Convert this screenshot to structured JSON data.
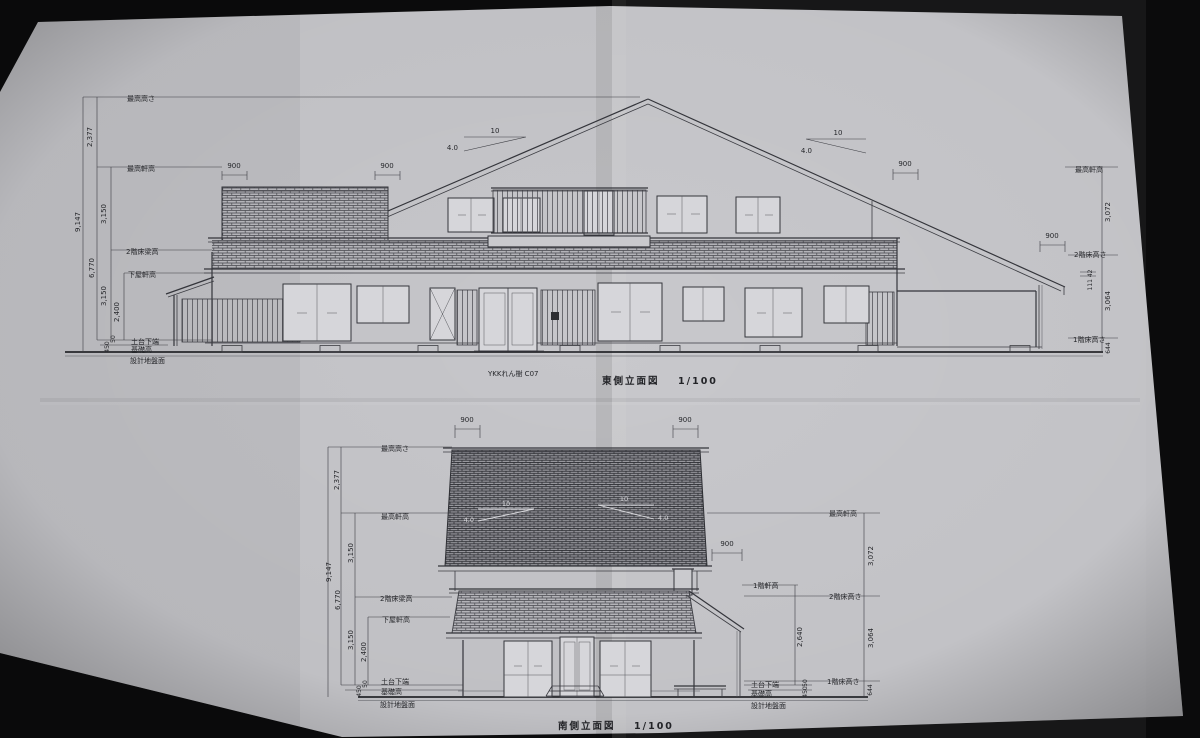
{
  "photo": {
    "background": "#0b0b0c",
    "paper": "#c6c6ca",
    "ink": "#34353b"
  },
  "east": {
    "title": "東側立面図",
    "scale": "1/100",
    "door_note": "YKKれん樹 C07",
    "labels": {
      "max_height": "最高高さ",
      "max_eave": "最高軒高",
      "fl2_beam": "2階床梁高",
      "lower_eave": "下屋軒高",
      "sill": "土台下端",
      "foundation": "基礎高",
      "ground": "設計地盤面",
      "fl2": "2階床高さ",
      "fl1": "1階床高さ"
    },
    "dims": {
      "total": "9,147",
      "top": "2,377",
      "upper": "3,150",
      "mid": "6,770",
      "lower": "3,150",
      "story1": "2,400",
      "base": "450",
      "base_s": "50",
      "r_top": "3,072",
      "r_mid": "3,064",
      "r_base": "644",
      "eave_note": "111 42",
      "oh1": "900",
      "oh2": "900",
      "oh3": "900",
      "oh4": "900"
    },
    "slope": {
      "run": "10",
      "rise": "4.0"
    }
  },
  "south": {
    "title": "南側立面図",
    "scale": "1/100",
    "labels": {
      "max_height": "最高高さ",
      "max_eave": "最高軒高",
      "fl2_beam": "2階床梁高",
      "lower_eave": "下屋軒高",
      "sill": "土台下端",
      "foundation": "基礎高",
      "ground": "設計地盤面",
      "fl2": "2階床高さ",
      "fl1": "1階床高さ",
      "eave1": "1階軒高"
    },
    "dims": {
      "total": "9,147",
      "top": "2,377",
      "upper": "3,150",
      "mid": "6,770",
      "lower": "3,150",
      "story1": "2,400",
      "base": "450",
      "base_s": "50",
      "r_top": "3,072",
      "r_mid": "3,064",
      "r_base": "644",
      "eave1": "2,640",
      "oh1": "900",
      "oh2": "900",
      "oh3": "900"
    },
    "slope": {
      "run": "10",
      "rise": "4.0"
    }
  }
}
